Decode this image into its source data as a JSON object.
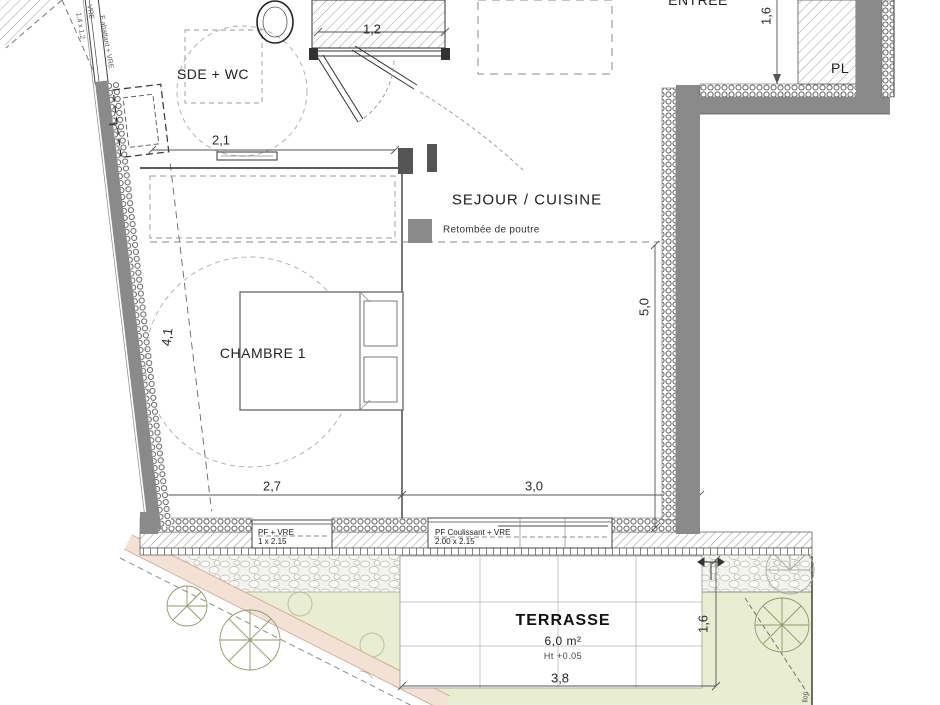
{
  "rooms": {
    "sde": "SDE + WC",
    "sejour": "SEJOUR / CUISINE",
    "chambre": "CHAMBRE 1",
    "entree": "ENTREE",
    "pl": "PL",
    "terrasse": "TERRASSE"
  },
  "terrasse_info": {
    "area": "6,0 m²",
    "level": "Ht +0.05"
  },
  "legend": {
    "beam": "Retombée de poutre"
  },
  "dimensions": {
    "top_block": "1,2",
    "sde_width": "2,1",
    "chambre_depth": "4,1",
    "chambre_width": "2,7",
    "sejour_width": "3,0",
    "sejour_depth": "5,0",
    "entree_depth": "1,6",
    "terrasse_depth": "1,6",
    "terrasse_width": "3,8"
  },
  "windows": {
    "left_label": "PF + VRE",
    "left_size": "1 x 2.15",
    "right_label": "PF Coulissant + VRE",
    "right_size": "2.00 x 2.15",
    "angled_label": "F abattant + VRE",
    "angled_type": "VRE",
    "angled_size": "1,4 x 1,2"
  },
  "edge_fragment": "llon",
  "colors": {
    "wall_gray": "#8a8a8a",
    "garden_green": "#e9edd2",
    "path_pink": "#f2e1d4",
    "gravel": "#f4f4f2",
    "line_dark": "#444444"
  }
}
